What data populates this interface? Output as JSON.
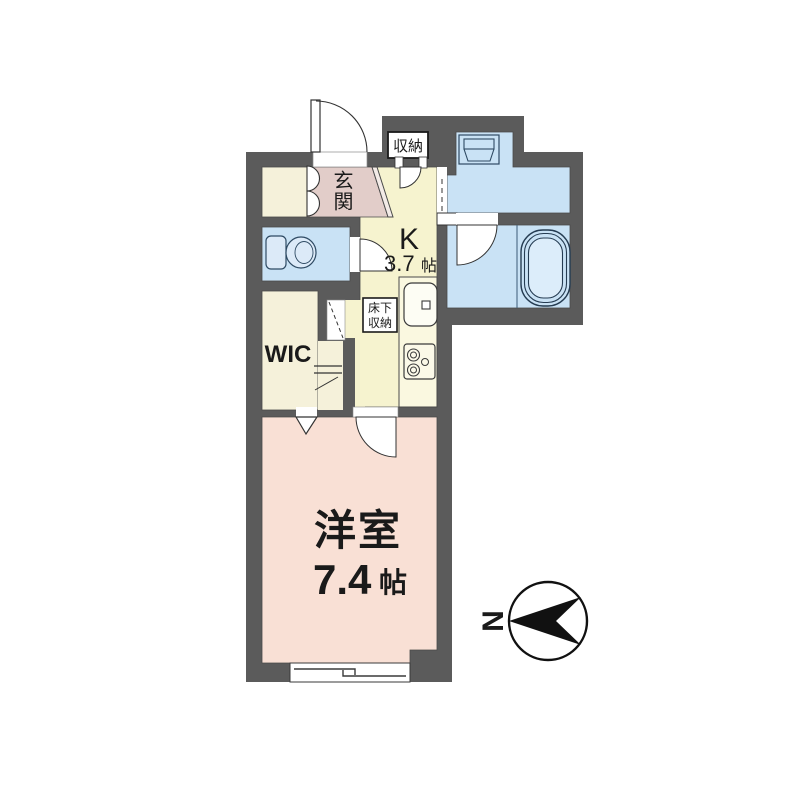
{
  "plan": {
    "rooms": {
      "entrance": {
        "label": "玄関"
      },
      "kitchen": {
        "label": "K",
        "size": "3.7",
        "unit": "帖"
      },
      "storage": {
        "label": "収納"
      },
      "underfloor_storage": {
        "line1": "床下",
        "line2": "収納"
      },
      "wic": {
        "label": "WIC"
      },
      "western_room": {
        "label": "洋室",
        "size": "7.4",
        "unit": "帖"
      }
    },
    "compass": {
      "north_label": "N"
    },
    "colors": {
      "wall": "#5b5b5b",
      "kitchen_floor": "#f6f3cf",
      "closet_floor": "#f5f1da",
      "entrance_floor": "#e2cdc9",
      "bedroom_floor": "#f9e0d5",
      "wet_area_floor": "#c9e2f5",
      "tub_inner": "#dcedfa",
      "fixture_fill": "#dceaf8",
      "white": "#ffffff"
    }
  }
}
